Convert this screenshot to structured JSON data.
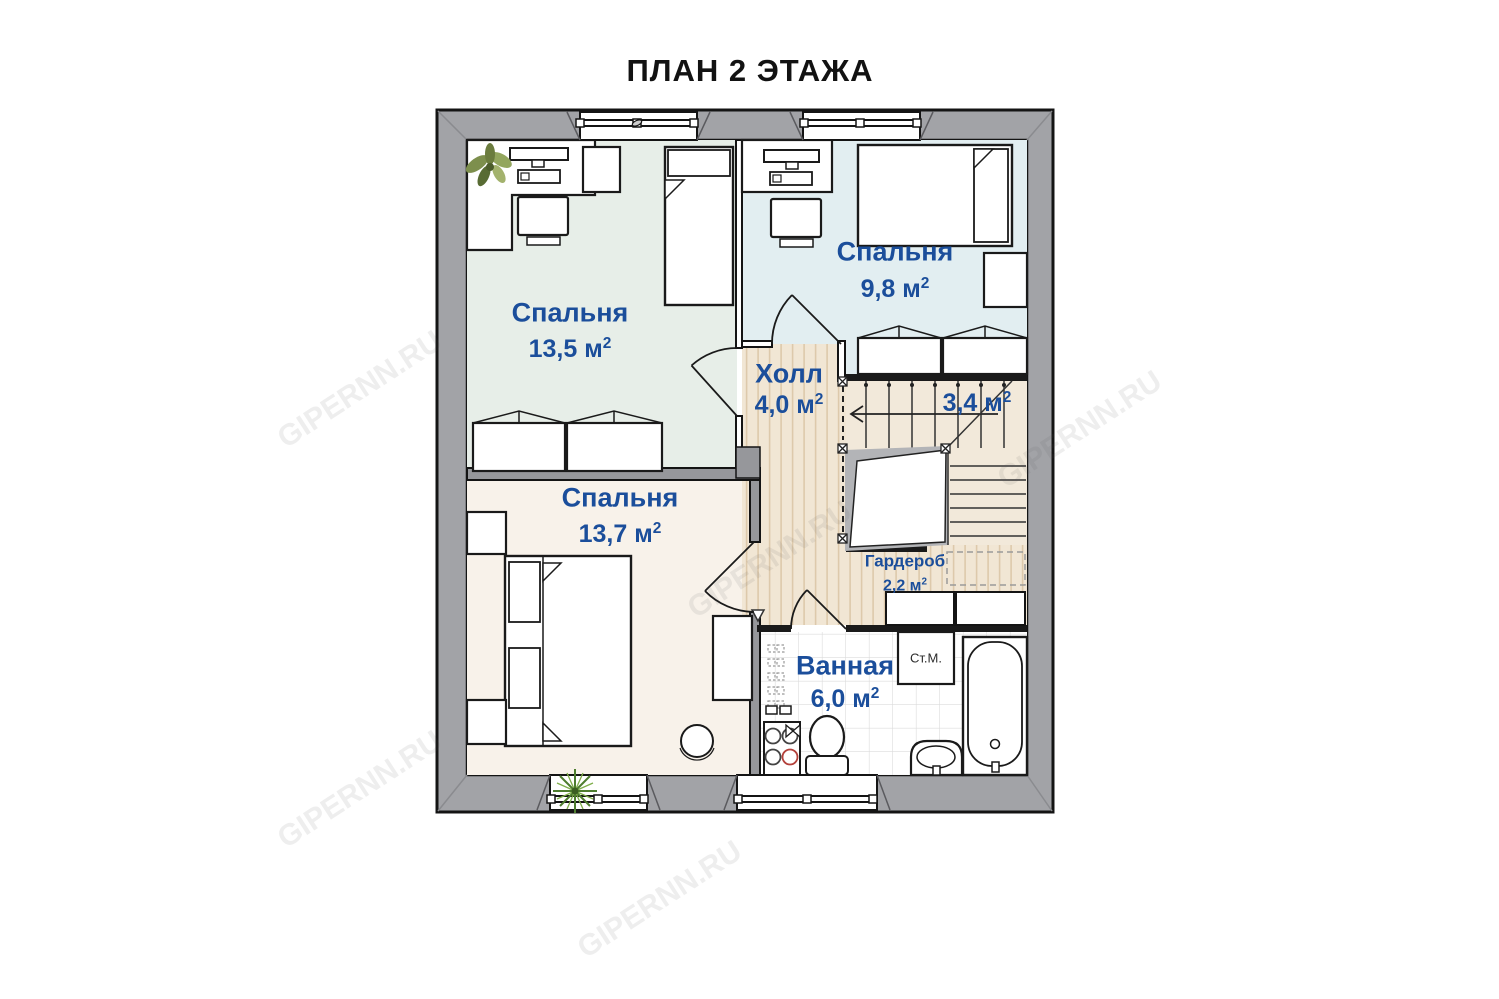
{
  "title": "ПЛАН 2 ЭТАЖА",
  "watermark": "GIPERNN.RU",
  "rooms": {
    "bedroom1": {
      "name": "Спальня",
      "area": "13,5",
      "unit": "м",
      "sup": "2"
    },
    "bedroom2": {
      "name": "Спальня",
      "area": "9,8",
      "unit": "м",
      "sup": "2"
    },
    "hall": {
      "name": "Холл",
      "area": "4,0",
      "unit": "м",
      "sup": "2"
    },
    "stairs": {
      "area": "3,4",
      "unit": "м",
      "sup": "2"
    },
    "bedroom3": {
      "name": "Спальня",
      "area": "13,7",
      "unit": "м",
      "sup": "2"
    },
    "wardrobe": {
      "name": "Гардероб",
      "area": "2,2",
      "unit": "м",
      "sup": "2"
    },
    "bathroom": {
      "name": "Ванная",
      "area": "6,0",
      "unit": "м",
      "sup": "2"
    }
  },
  "labels": {
    "washing_machine": "Ст.М."
  },
  "colors": {
    "label_blue": "#1b4e9b",
    "wall_gray": "#a2a3a7",
    "floor_bedroom1": "#e7eee8",
    "floor_bedroom2": "#e2eef1",
    "floor_bedroom3": "#f8f2ea",
    "floor_wood": "#f1e6d4",
    "floor_stairs": "#f2e9da",
    "burner_red": "#b3403a"
  }
}
